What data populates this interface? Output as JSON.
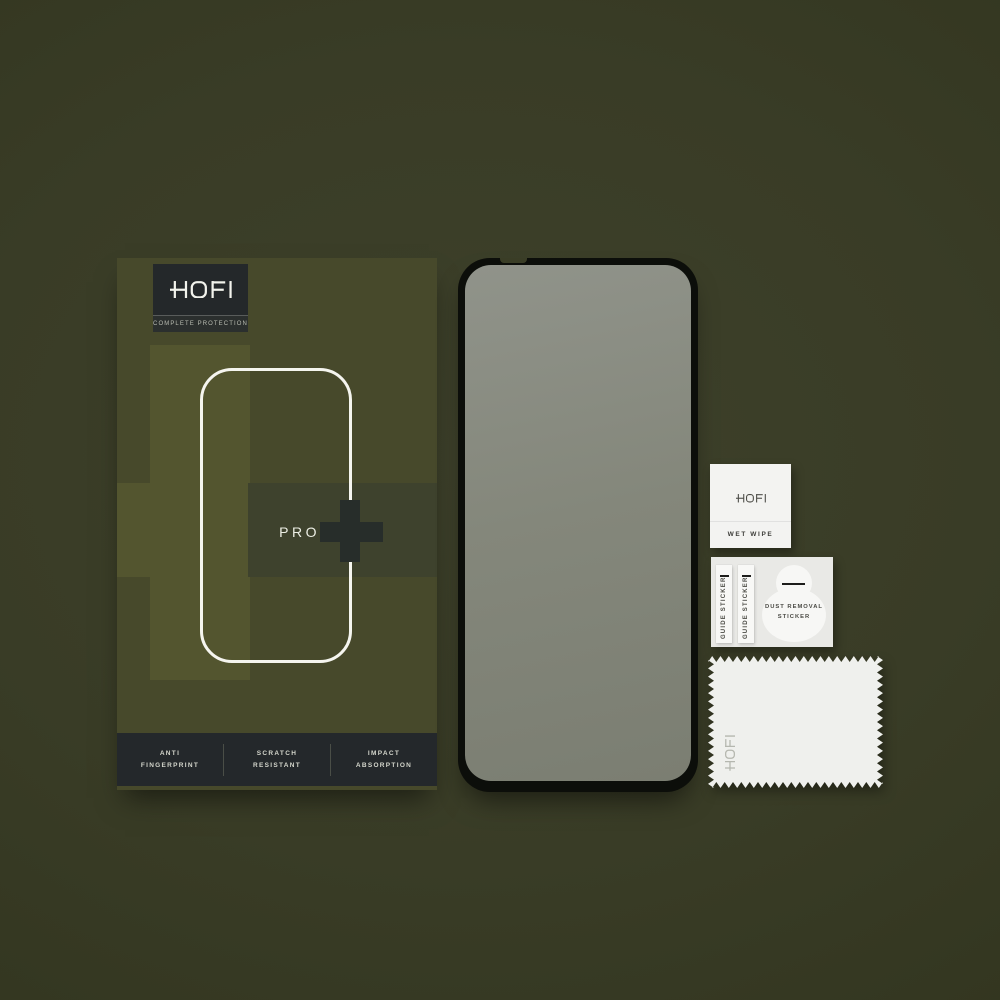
{
  "product": {
    "brand": "HOFI",
    "tagline": "COMPLETE PROTECTION",
    "model": "PRO",
    "model_suffix": "+",
    "features": [
      {
        "line1": "ANTI",
        "line2": "FINGERPRINT"
      },
      {
        "line1": "SCRATCH",
        "line2": "RESISTANT"
      },
      {
        "line1": "IMPACT",
        "line2": "ABSORPTION"
      }
    ]
  },
  "accessories": {
    "wet_wipe": {
      "brand": "HOFI",
      "label": "WET WIPE"
    },
    "guide_stickers": {
      "label": "GUIDE STICKER",
      "count": 2
    },
    "dust_sticker": {
      "line1": "DUST REMOVAL",
      "line2": "STICKER"
    },
    "cloth": {
      "brand": "HOFI"
    }
  },
  "icons": {
    "hofi_logo": "hofi-logotype",
    "plus": "plus-icon",
    "phone_outline": "phone-outline-graphic"
  },
  "colors": {
    "background": "#393c26",
    "box_base": "#47492b",
    "box_light_cross": "#53552f",
    "box_dark_band": "#3e422d",
    "dark_plus": "#272d2a",
    "panel_charcoal": "#24282a",
    "accent_white": "#f5f5ef",
    "protector_frame": "#0c0e0a",
    "glass_top": "#90938a",
    "glass_bottom": "#7b7e72",
    "paper_white": "#f3f3f1",
    "card_gray": "#e9e9e6"
  }
}
